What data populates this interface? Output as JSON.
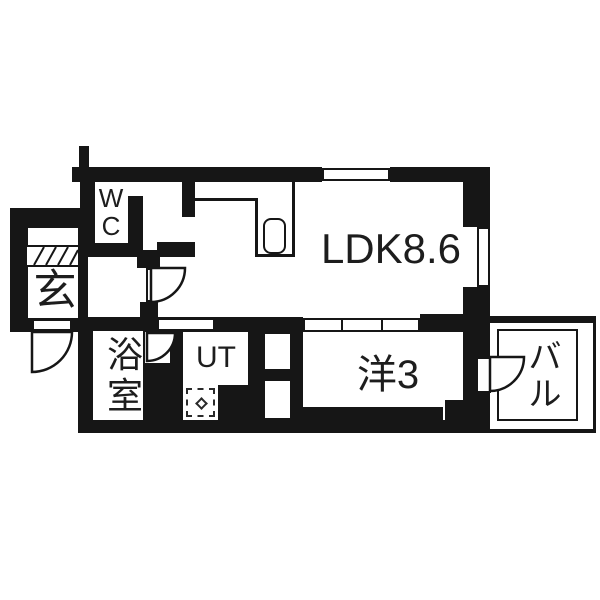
{
  "plan_title": "1LDK floor plan",
  "colors": {
    "wall": "#161616",
    "background": "#ffffff",
    "text": "#1d1d1d"
  },
  "rooms": {
    "wc": {
      "label": "WC",
      "vertical": true
    },
    "genkan": {
      "label": "玄",
      "vertical": false
    },
    "bath": {
      "label": "浴室",
      "vertical": true
    },
    "utility": {
      "label": "UT",
      "vertical": false
    },
    "ldk": {
      "label": "LDK8.6",
      "vertical": false
    },
    "western": {
      "label": "洋3",
      "vertical": false
    },
    "balcony": {
      "label": "バル",
      "vertical": true
    }
  }
}
